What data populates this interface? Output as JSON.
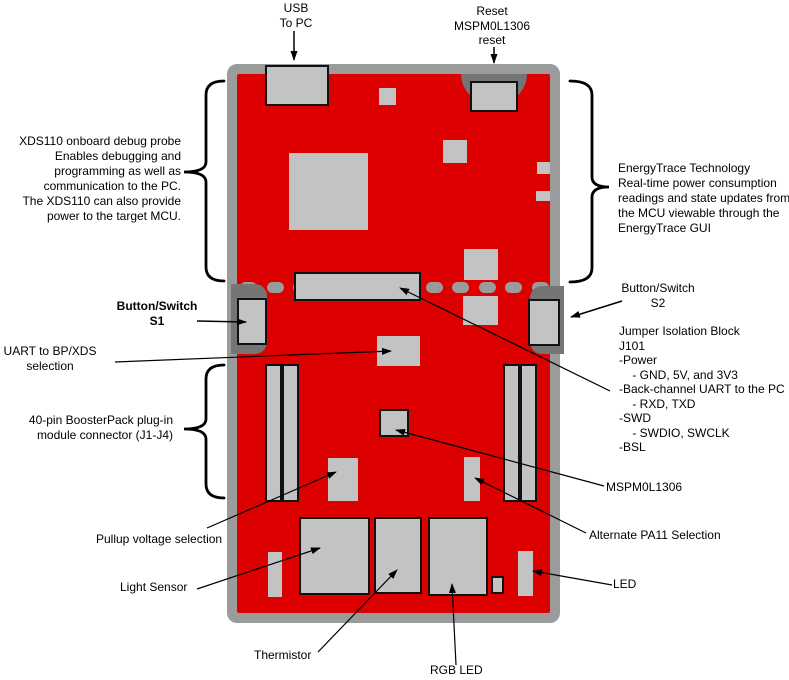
{
  "colors": {
    "board_red": "#dc0000",
    "board_border_gray": "#9b9b9b",
    "component_gray": "#c3c3c3",
    "notch_dark_gray": "#757575",
    "line_black": "#000000"
  },
  "callouts": {
    "usb": "USB\nTo PC",
    "reset": "Reset\nMSPM0L1306\nreset",
    "xds110": "XDS110 onboard debug probe\nEnables debugging and\nprogramming as well as\ncommunication to the PC.\nThe XDS110 can also provide\npower to the target MCU.",
    "energytrace": "EnergyTrace Technology\nReal-time power consumption\nreadings and state updates from\nthe MCU viewable through the\nEnergyTrace GUI",
    "button_s1": "Button/Switch\nS1",
    "button_s2": "Button/Switch\nS2",
    "jumper_block": "Jumper Isolation Block\nJ101\n-Power\n    - GND, 5V, and 3V3\n-Back-channel UART to the PC\n    - RXD, TXD\n-SWD\n    - SWDIO, SWCLK\n-BSL",
    "uart": "UART to BP/XDS\nselection",
    "boosterpack": "40-pin BoosterPack plug-in\nmodule connector (J1-J4)",
    "mspm0l1306": "MSPM0L1306",
    "alt_pa11": "Alternate PA11 Selection",
    "pullup": "Pullup voltage selection",
    "light_sensor": "Light Sensor",
    "thermistor": "Thermistor",
    "rgb_led": "RGB LED",
    "led": "LED"
  },
  "dash_row": {
    "count": 12,
    "start_x": 240,
    "spacing": 26.5
  }
}
